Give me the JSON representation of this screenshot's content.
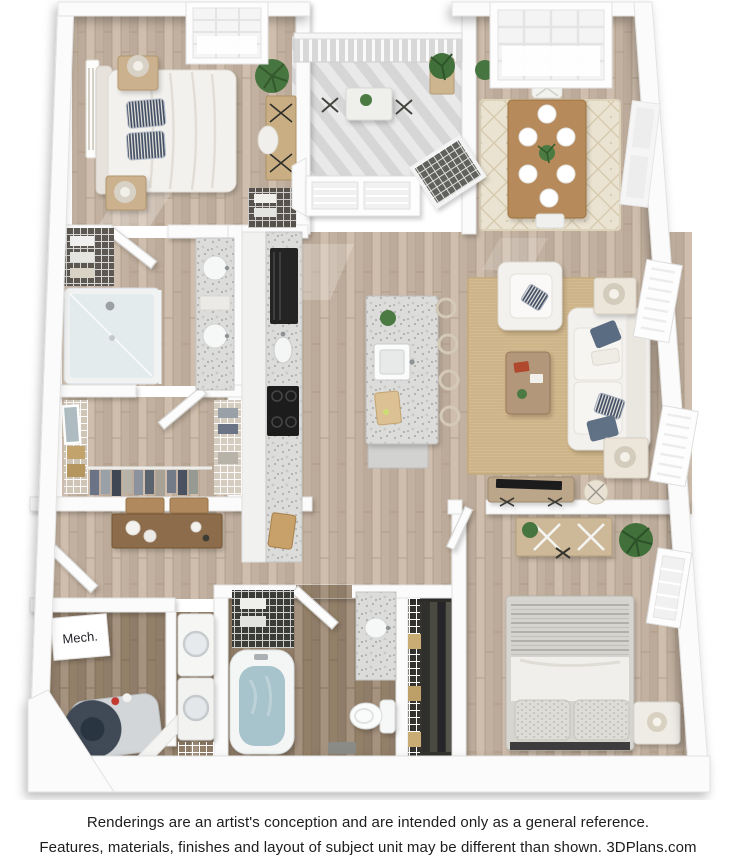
{
  "footer": {
    "line1": "Renderings are an artist's conception and are intended only as a general reference.",
    "line2": "Features, materials, finishes and layout of subject unit may be different than shown. 3DPlans.com"
  },
  "plan": {
    "type": "3d-floor-plan-top-view",
    "label_mech": "Mech.",
    "brand": "3DPlans.com",
    "colors": {
      "wall": "#fbfbfb",
      "wall_edge": "#e2e2e0",
      "floor_wood_light": "#c7b6a5",
      "floor_wood_dark": "#9a8774",
      "rug_cream": "#ebe3d1",
      "rug_tan": "#d4ba90",
      "granite": "#dcdcda",
      "appliance_black": "#1f1f1f",
      "bath_water_blue": "#a7c3cb",
      "upholstery_white": "#f3f1ee",
      "pillow_navy": "#5a6c82",
      "plant_green": "#47753f",
      "wood_furniture": "#b08a5e",
      "water_heater_navy": "#3f4a57"
    },
    "rooms": [
      {
        "name": "Bedroom 1",
        "furniture": [
          "bed",
          "2 nightstands",
          "2 lamps",
          "wall art",
          "desk with chair",
          "plant",
          "small closet",
          "window"
        ]
      },
      {
        "name": "Balcony",
        "furniture": [
          "railing",
          "bistro table",
          "2 chairs",
          "potted plants",
          "bay windows"
        ]
      },
      {
        "name": "Dining Room",
        "furniture": [
          "dining table",
          "6 place settings",
          "chairs",
          "centerpiece plant",
          "area rug",
          "window"
        ]
      },
      {
        "name": "Kitchen",
        "furniture": [
          "refrigerator",
          "cooktop",
          "counter sink",
          "island with sink",
          "4 bar stools",
          "cutting boards"
        ]
      },
      {
        "name": "Living Room",
        "furniture": [
          "sofa",
          "armchair",
          "throw pillows",
          "coffee table",
          "2 end tables with lamps",
          "media console with TV",
          "pouf",
          "area rug",
          "2 windows"
        ]
      },
      {
        "name": "Bathroom 1",
        "furniture": [
          "walk-in shower",
          "double-sink granite vanity",
          "linen shelves"
        ]
      },
      {
        "name": "Walk-in Closet",
        "furniture": [
          "wire shelving",
          "hanging clothes",
          "baskets",
          "mirror"
        ]
      },
      {
        "name": "Entry Hall",
        "furniture": [
          "console table",
          "wall shelves",
          "front door"
        ]
      },
      {
        "name": "Mech. Room",
        "furniture": [
          "water heater",
          "mech sign"
        ]
      },
      {
        "name": "Laundry",
        "furniture": [
          "washer",
          "dryer",
          "wire shelf"
        ]
      },
      {
        "name": "Bathroom 2",
        "furniture": [
          "bathtub",
          "toilet",
          "granite vanity",
          "linen closet",
          "bath mat"
        ]
      },
      {
        "name": "Closet 2",
        "furniture": [
          "wire shelving",
          "hanging clothes",
          "baskets"
        ]
      },
      {
        "name": "Bedroom 2",
        "furniture": [
          "bed",
          "desk with chair",
          "nightstand with lamp",
          "plant",
          "window"
        ]
      }
    ]
  }
}
